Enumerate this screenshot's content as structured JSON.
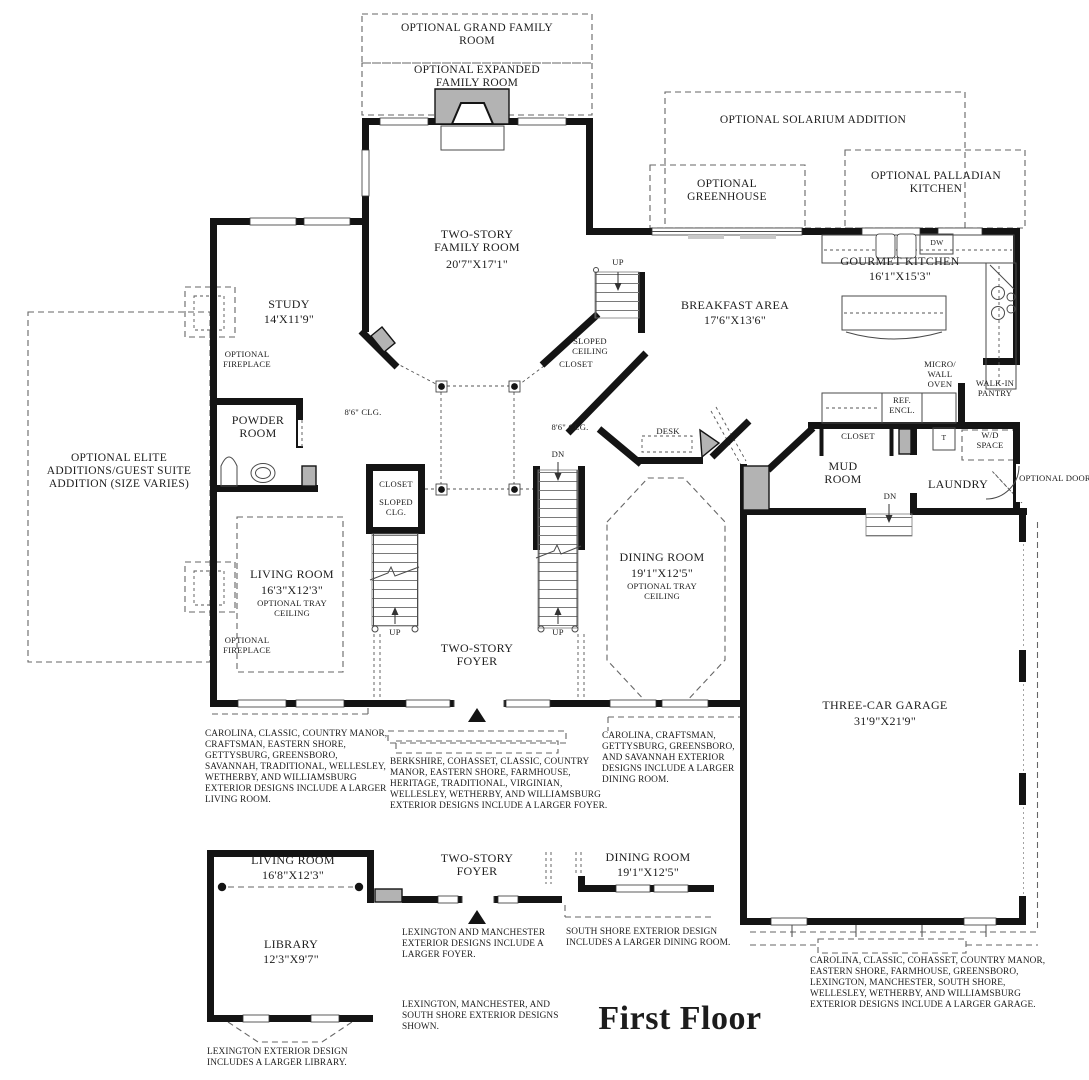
{
  "title": "First Floor",
  "optional": {
    "grand_family_room": "OPTIONAL GRAND FAMILY ROOM",
    "expanded_family_room": "OPTIONAL EXPANDED FAMILY ROOM",
    "solarium": "OPTIONAL SOLARIUM ADDITION",
    "greenhouse": "OPTIONAL GREENHOUSE",
    "palladian_kitchen": "OPTIONAL PALLADIAN KITCHEN",
    "elite_additions": "OPTIONAL ELITE ADDITIONS/GUEST SUITE ADDITION (SIZE VARIES)",
    "fireplace": "OPTIONAL FIREPLACE",
    "tray_ceiling": "OPTIONAL TRAY CEILING",
    "door": "OPTIONAL DOOR"
  },
  "rooms": {
    "study": {
      "name": "STUDY",
      "dims": "14'X11'9\""
    },
    "family_room": {
      "name": "TWO-STORY FAMILY ROOM",
      "dims": "20'7\"X17'1\""
    },
    "breakfast_area": {
      "name": "BREAKFAST AREA",
      "dims": "17'6\"X13'6\""
    },
    "gourmet_kitchen": {
      "name": "GOURMET KITCHEN",
      "dims": "16'1\"X15'3\""
    },
    "powder_room": {
      "name": "POWDER ROOM"
    },
    "living_room": {
      "name": "LIVING ROOM",
      "dims": "16'3\"X12'3\""
    },
    "foyer": {
      "name": "TWO-STORY FOYER"
    },
    "dining_room": {
      "name": "DINING ROOM",
      "dims": "19'1\"X12'5\""
    },
    "mud_room": {
      "name": "MUD ROOM"
    },
    "laundry": {
      "name": "LAUNDRY"
    },
    "pantry": {
      "name": "WALK-IN PANTRY"
    },
    "garage": {
      "name": "THREE-CAR GARAGE",
      "dims": "31'9\"X21'9\""
    }
  },
  "annotations": {
    "up": "UP",
    "dn": "DN",
    "closet": "CLOSET",
    "sloped_ceiling": "SLOPED CEILING",
    "sloped_clg": "SLOPED CLG.",
    "clg_8_6": "8'6\" CLG.",
    "desk": "DESK",
    "dw": "DW",
    "micro_wall_oven": "MICRO/ WALL OVEN",
    "ref_encl": "REF. ENCL.",
    "t": "T",
    "wd_space": "W/D SPACE"
  },
  "notes": {
    "larger_living_room": "CAROLINA, CLASSIC, COUNTRY MANOR, CRAFTSMAN, EASTERN SHORE, GETTYSBURG, GREENSBORO, SAVANNAH, TRADITIONAL, WELLESLEY, WETHERBY, AND WILLIAMSBURG EXTERIOR DESIGNS INCLUDE A LARGER LIVING ROOM.",
    "larger_foyer": "BERKSHIRE, COHASSET, CLASSIC, COUNTRY MANOR, EASTERN SHORE, FARMHOUSE, HERITAGE, TRADITIONAL, VIRGINIAN, WELLESLEY, WETHERBY, AND WILLIAMSBURG EXTERIOR DESIGNS INCLUDE A LARGER FOYER.",
    "larger_dining": "CAROLINA, CRAFTSMAN, GETTYSBURG, GREENSBORO, AND SAVANNAH EXTERIOR DESIGNS INCLUDE A LARGER DINING ROOM.",
    "larger_garage": "CAROLINA, CLASSIC, COHASSET, COUNTRY MANOR, EASTERN SHORE, FARMHOUSE, GREENSBORO, LEXINGTON, MANCHESTER, SOUTH SHORE, WELLESLEY, WETHERBY, AND WILLIAMSBURG EXTERIOR DESIGNS INCLUDE A LARGER GARAGE."
  },
  "alt_plan": {
    "living_room": {
      "name": "LIVING ROOM",
      "dims": "16'8\"X12'3\""
    },
    "library": {
      "name": "LIBRARY",
      "dims": "12'3\"X9'7\""
    },
    "foyer": {
      "name": "TWO-STORY FOYER"
    },
    "dining_room": {
      "name": "DINING ROOM",
      "dims": "19'1\"X12'5\""
    },
    "notes": {
      "larger_foyer": "LEXINGTON AND MANCHESTER EXTERIOR DESIGNS INCLUDE A LARGER FOYER.",
      "larger_dining": "SOUTH SHORE EXTERIOR DESIGN INCLUDES A LARGER DINING ROOM.",
      "designs_shown": "LEXINGTON, MANCHESTER, AND SOUTH SHORE EXTERIOR DESIGNS SHOWN.",
      "larger_library": "LEXINGTON EXTERIOR DESIGN INCLUDES A LARGER LIBRARY."
    }
  }
}
